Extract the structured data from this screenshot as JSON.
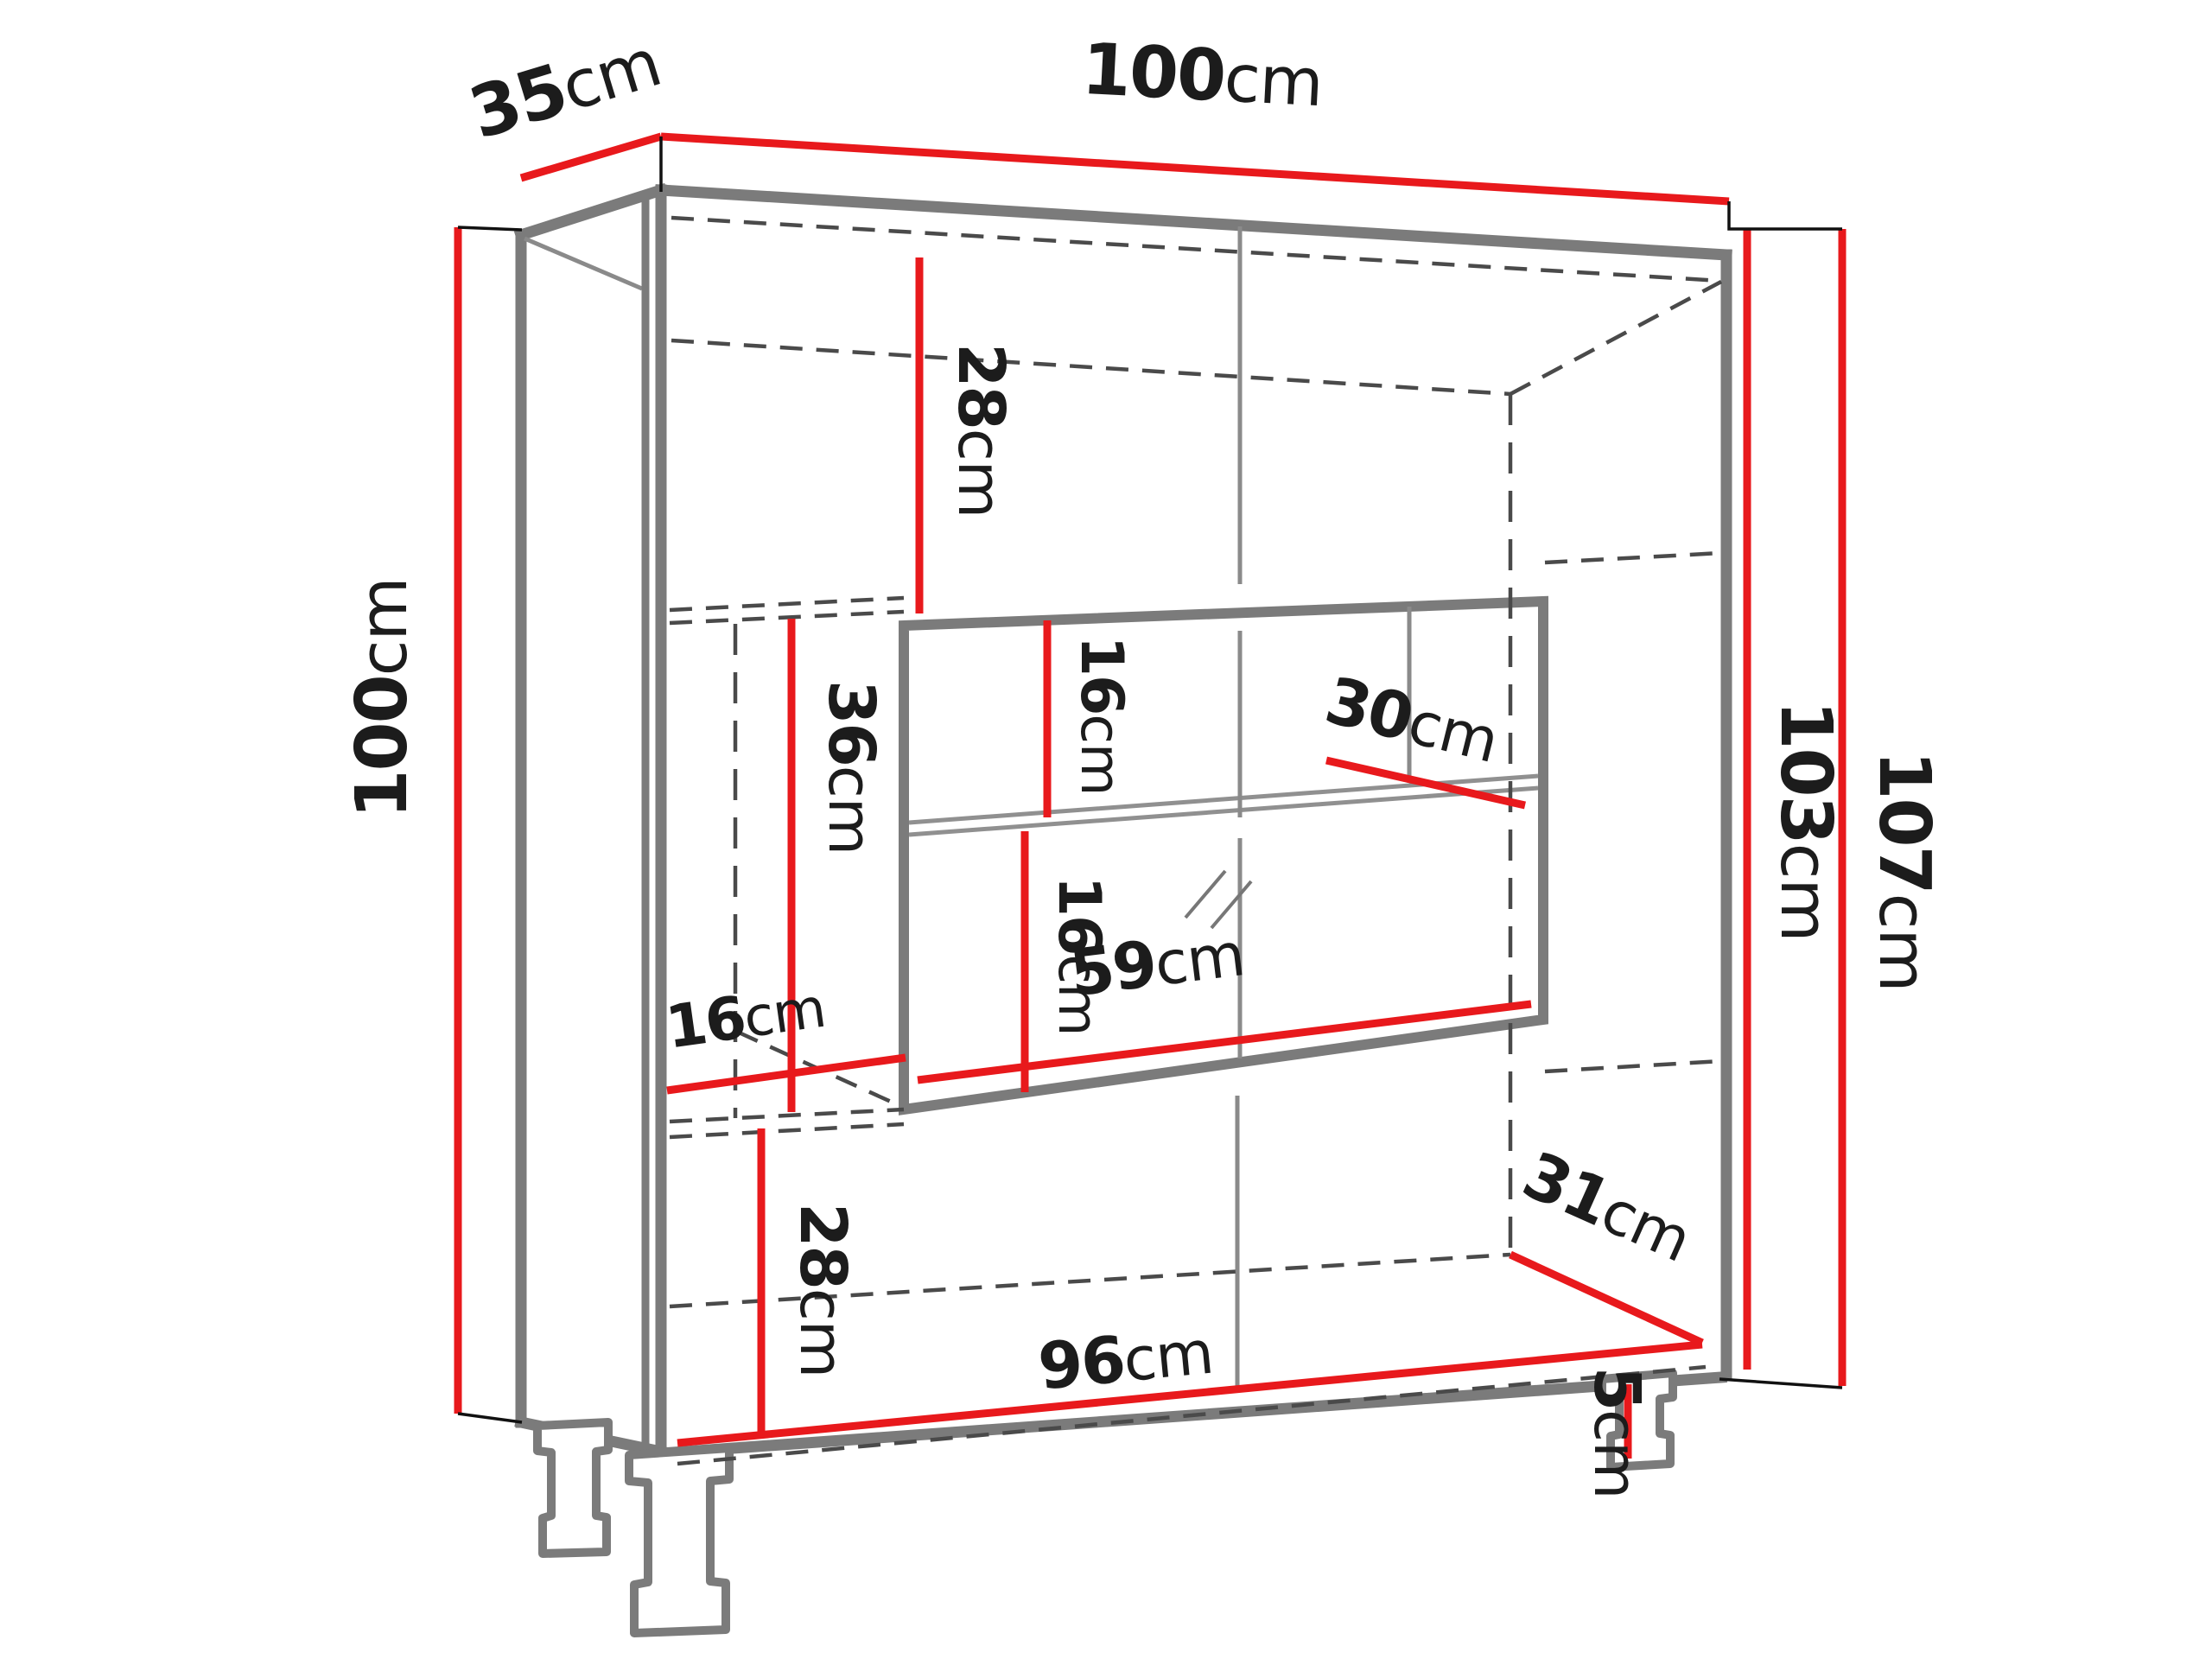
{
  "title": "Cabinet dimension diagram",
  "diagram_type": "furniture technical line drawing with dimension lines",
  "units": "cm",
  "colors": {
    "background": "#ffffff",
    "dimension_line": "#e8191c",
    "cabinet_outline": "#7b7b7b",
    "hidden_edge": "#4a4a4a",
    "label_text": "#1c1c1c"
  },
  "labels": {
    "d35": {
      "value": "35",
      "unit": "cm"
    },
    "d100top": {
      "value": "100",
      "unit": "cm"
    },
    "d100left": {
      "value": "100",
      "unit": "cm"
    },
    "d103": {
      "value": "103",
      "unit": "cm"
    },
    "d107": {
      "value": "107",
      "unit": "cm"
    },
    "d28top": {
      "value": "28",
      "unit": "cm"
    },
    "d16upper": {
      "value": "16",
      "unit": "cm"
    },
    "d30": {
      "value": "30",
      "unit": "cm"
    },
    "d36": {
      "value": "36",
      "unit": "cm"
    },
    "d16lower": {
      "value": "16",
      "unit": "cm"
    },
    "d16left": {
      "value": "16",
      "unit": "cm"
    },
    "d59": {
      "value": "59",
      "unit": "cm"
    },
    "d28bottom": {
      "value": "28",
      "unit": "cm"
    },
    "d31": {
      "value": "31",
      "unit": "cm"
    },
    "d96": {
      "value": "96",
      "unit": "cm"
    },
    "d5": {
      "value": "5",
      "unit": "cm"
    }
  }
}
